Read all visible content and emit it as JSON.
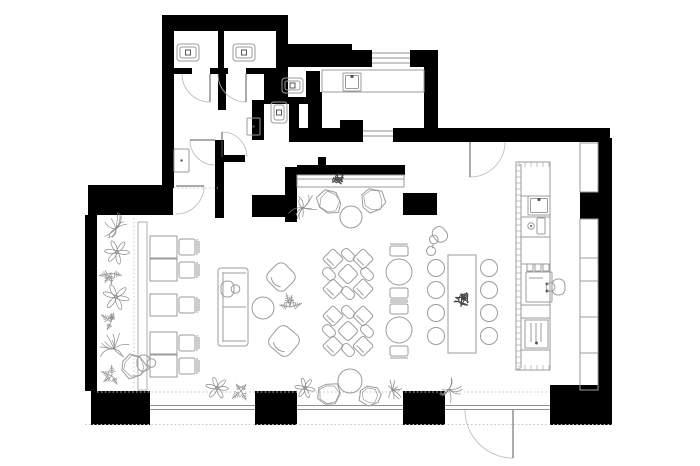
{
  "plan": {
    "name": "cafe-floor-plan",
    "canvas": {
      "width": 700,
      "height": 466,
      "background": "#ffffff"
    },
    "colors": {
      "wall": "#000000",
      "furniture": "#9b9b9b",
      "accent": "#555555",
      "plant": "#8a8a8a",
      "scribble": "#474747",
      "dotted": "#c4c4c4",
      "window": "#8f8f8f"
    },
    "walls": [
      [
        162,
        15,
        126,
        16
      ],
      [
        162,
        15,
        12,
        173
      ],
      [
        218,
        31,
        6,
        40
      ],
      [
        276,
        31,
        12,
        40
      ],
      [
        285,
        44,
        67,
        23
      ],
      [
        352,
        50,
        20,
        17
      ],
      [
        410,
        50,
        28,
        17
      ],
      [
        424,
        60,
        14,
        82
      ],
      [
        430,
        128,
        180,
        14
      ],
      [
        598,
        138,
        14,
        250
      ],
      [
        580,
        192,
        18,
        27
      ],
      [
        550,
        385,
        62,
        40
      ],
      [
        403,
        391,
        42,
        34
      ],
      [
        255,
        391,
        42,
        34
      ],
      [
        91,
        391,
        59,
        34
      ],
      [
        85,
        215,
        12,
        176
      ],
      [
        88,
        185,
        85,
        30
      ],
      [
        174,
        68,
        18,
        6
      ],
      [
        210,
        68,
        18,
        6
      ],
      [
        246,
        68,
        30,
        6
      ],
      [
        218,
        74,
        8,
        36
      ],
      [
        215,
        140,
        9,
        78
      ],
      [
        264,
        71,
        24,
        28
      ],
      [
        306,
        71,
        14,
        29
      ],
      [
        264,
        97,
        50,
        7
      ],
      [
        252,
        100,
        12,
        40
      ],
      [
        289,
        100,
        10,
        42
      ],
      [
        217,
        155,
        28,
        7
      ],
      [
        252,
        195,
        45,
        22
      ],
      [
        285,
        167,
        12,
        55
      ],
      [
        297,
        165,
        108,
        10
      ],
      [
        318,
        157,
        8,
        8
      ],
      [
        403,
        193,
        34,
        22
      ],
      [
        308,
        92,
        14,
        48
      ],
      [
        310,
        128,
        53,
        14
      ],
      [
        393,
        128,
        45,
        14
      ],
      [
        289,
        128,
        21,
        14
      ],
      [
        340,
        120,
        23,
        10
      ]
    ],
    "windows": [
      {
        "name": "window-kitchen-top",
        "x1": 372,
        "x2": 410,
        "ys": [
          53,
          58,
          63
        ]
      },
      {
        "name": "pass-through-window",
        "x1": 363,
        "x2": 393,
        "ys": [
          131,
          136
        ]
      },
      {
        "name": "window-bottom-left",
        "x1": 150,
        "x2": 255,
        "ys": [
          405.5,
          409.5
        ]
      },
      {
        "name": "window-bottom-center",
        "x1": 297,
        "x2": 403,
        "ys": [
          405.5,
          409.5
        ]
      },
      {
        "name": "entry-frame",
        "x1": 445,
        "x2": 550,
        "ys": [
          405.5,
          409.5
        ]
      }
    ],
    "doors": [
      {
        "name": "door-wc-stall-1",
        "cx": 210,
        "cy": 74,
        "r": 28,
        "a1": 90,
        "a2": 180,
        "leaf": "a1"
      },
      {
        "name": "door-wc-stall-2",
        "cx": 246,
        "cy": 74,
        "r": 28,
        "a1": 90,
        "a2": 180,
        "leaf": "a1"
      },
      {
        "name": "door-vestibule",
        "cx": 222,
        "cy": 157,
        "r": 25,
        "a1": 270,
        "a2": 360,
        "leaf": "a1"
      },
      {
        "name": "door-back-room",
        "cx": 215,
        "cy": 140,
        "r": 25,
        "a1": 90,
        "a2": 180,
        "leaf": "a2"
      },
      {
        "name": "door-hall-to-cafe",
        "cx": 176,
        "cy": 186,
        "r": 28,
        "a1": 0,
        "a2": 90,
        "leaf": "a1"
      },
      {
        "name": "door-service",
        "cx": 470,
        "cy": 142,
        "r": 35,
        "a1": 0,
        "a2": 90,
        "leaf": "a2"
      },
      {
        "name": "door-main-entrance",
        "cx": 513,
        "cy": 410,
        "r": 48,
        "a1": 90,
        "a2": 180,
        "leaf": "a1"
      }
    ],
    "dotted_lines": [
      [
        97,
        392,
        550,
        392
      ],
      [
        85,
        424.5,
        612,
        424.5
      ],
      [
        134,
        218,
        134,
        391
      ],
      [
        174,
        188,
        218,
        188
      ]
    ],
    "furniture": [
      {
        "type": "toilet",
        "name": "toilet",
        "x": 177,
        "y": 44,
        "w": 22,
        "h": 17
      },
      {
        "type": "toilet",
        "name": "toilet",
        "x": 233,
        "y": 44,
        "w": 22,
        "h": 17
      },
      {
        "type": "toilet",
        "name": "toilet",
        "x": 282,
        "y": 78,
        "w": 21,
        "h": 15
      },
      {
        "type": "toilet",
        "name": "toilet",
        "x": 271,
        "y": 102,
        "w": 16,
        "h": 21
      },
      {
        "type": "sink",
        "name": "washbasin",
        "x": 343,
        "y": 73,
        "w": 18,
        "h": 18
      },
      {
        "type": "sink",
        "name": "bar-sink",
        "x": 528,
        "y": 196,
        "w": 22,
        "h": 19
      },
      {
        "type": "panel",
        "name": "wall-fixture",
        "x": 174,
        "y": 149,
        "w": 15,
        "h": 23
      },
      {
        "type": "panel",
        "name": "wall-fixture",
        "x": 247,
        "y": 118,
        "w": 13,
        "h": 17
      },
      {
        "type": "counter",
        "name": "kitchen-counter",
        "x": 322,
        "y": 70,
        "w": 102,
        "h": 22
      },
      {
        "type": "bar",
        "name": "bar-counter",
        "x": 516,
        "y": 162,
        "w": 34,
        "h": 208
      },
      {
        "type": "tap",
        "name": "bar-tap",
        "x": 527,
        "y": 218
      },
      {
        "type": "coffee_machine",
        "name": "coffee-machine",
        "x": 526,
        "y": 264,
        "w": 26,
        "h": 38
      },
      {
        "type": "appliance",
        "name": "under-counter-appliance",
        "x": 525,
        "y": 320,
        "w": 23,
        "h": 28
      },
      {
        "type": "shelf",
        "name": "wall-shelf",
        "x": 580,
        "y": 143,
        "w": 18,
        "h": 49
      },
      {
        "type": "shelf",
        "name": "wall-shelf",
        "x": 580,
        "y": 219,
        "w": 18,
        "h": 39
      },
      {
        "type": "shelf",
        "name": "wall-shelf",
        "x": 580,
        "y": 258,
        "w": 18,
        "h": 23
      },
      {
        "type": "shelf",
        "name": "wall-shelf",
        "x": 580,
        "y": 281,
        "w": 18,
        "h": 36
      },
      {
        "type": "shelf",
        "name": "wall-shelf",
        "x": 580,
        "y": 317,
        "w": 18,
        "h": 36
      },
      {
        "type": "shelf",
        "name": "wall-shelf",
        "x": 580,
        "y": 353,
        "w": 18,
        "h": 37
      },
      {
        "type": "bench",
        "name": "banquette-bench",
        "x": 297,
        "y": 175,
        "w": 107,
        "h": 12
      },
      {
        "type": "bench_line",
        "name": "wall-bench",
        "x": 138,
        "y": 222,
        "w": 9,
        "h": 168
      },
      {
        "type": "table_chair",
        "name": "table-for-one",
        "x": 150,
        "y": 236
      },
      {
        "type": "table_chair",
        "name": "table-for-one",
        "x": 150,
        "y": 259
      },
      {
        "type": "table_chair",
        "name": "table-for-one",
        "x": 150,
        "y": 294
      },
      {
        "type": "table_chair",
        "name": "table-for-one",
        "x": 150,
        "y": 332
      },
      {
        "type": "table_chair",
        "name": "table-for-one",
        "x": 150,
        "y": 355
      },
      {
        "type": "sofa",
        "name": "lounge-sofa",
        "x": 218,
        "y": 268,
        "w": 30,
        "h": 78
      },
      {
        "type": "person",
        "name": "seated-guest",
        "x": 230,
        "y": 289,
        "rot": 0
      },
      {
        "type": "round_table",
        "name": "coffee-table",
        "cx": 263,
        "cy": 308,
        "r": 11
      },
      {
        "type": "armchair",
        "name": "armchair",
        "cx": 281,
        "cy": 277,
        "s": 24,
        "rot": 45
      },
      {
        "type": "armchair",
        "name": "armchair",
        "cx": 284,
        "cy": 341,
        "s": 26,
        "rot": 40
      },
      {
        "type": "blob_chair",
        "name": "lounge-chair",
        "cx": 329,
        "cy": 202,
        "r": 13,
        "seed": 3
      },
      {
        "type": "blob_chair",
        "name": "lounge-chair",
        "cx": 373,
        "cy": 201,
        "r": 13,
        "seed": 7
      },
      {
        "type": "round_table",
        "name": "round-table",
        "cx": 351,
        "cy": 217,
        "r": 11
      },
      {
        "type": "cluster4",
        "name": "four-seat-table",
        "cx": 348,
        "cy": 274
      },
      {
        "type": "cluster4",
        "name": "four-seat-table",
        "cx": 348,
        "cy": 331
      },
      {
        "type": "table_2chairs",
        "name": "two-seat-table",
        "cx": 399,
        "cy": 272,
        "r": 13
      },
      {
        "type": "table_2chairs",
        "name": "two-seat-table",
        "cx": 399,
        "cy": 330,
        "r": 13
      },
      {
        "type": "comm_table",
        "name": "communal-table",
        "x": 448,
        "y": 255,
        "w": 28,
        "h": 98
      },
      {
        "type": "stool",
        "name": "stool",
        "cx": 436,
        "cy": 268,
        "r": 8.5
      },
      {
        "type": "stool",
        "name": "stool",
        "cx": 436,
        "cy": 290,
        "r": 8.5
      },
      {
        "type": "stool",
        "name": "stool",
        "cx": 436,
        "cy": 313,
        "r": 8.5
      },
      {
        "type": "stool",
        "name": "stool",
        "cx": 436,
        "cy": 336,
        "r": 8.5
      },
      {
        "type": "stool",
        "name": "stool",
        "cx": 489,
        "cy": 268,
        "r": 8.5
      },
      {
        "type": "stool",
        "name": "stool",
        "cx": 489,
        "cy": 290,
        "r": 8.5
      },
      {
        "type": "stool",
        "name": "stool",
        "cx": 489,
        "cy": 313,
        "r": 8.5
      },
      {
        "type": "stool",
        "name": "stool",
        "cx": 489,
        "cy": 336,
        "r": 8.5
      },
      {
        "type": "person",
        "name": "waiter",
        "x": 438,
        "y": 236,
        "rot": 140,
        "tray": true
      },
      {
        "type": "person",
        "name": "barista",
        "x": 556,
        "y": 287,
        "rot": 180
      },
      {
        "type": "person",
        "name": "seated-guest",
        "x": 146,
        "y": 363,
        "rot": 0
      },
      {
        "type": "blob_chair",
        "name": "lounge-chair",
        "cx": 134,
        "cy": 366,
        "r": 13,
        "seed": 11
      },
      {
        "type": "blob_chair",
        "name": "window-chair",
        "cx": 329,
        "cy": 394,
        "r": 12,
        "seed": 5
      },
      {
        "type": "round_table",
        "name": "round-table",
        "cx": 350,
        "cy": 381,
        "r": 12
      },
      {
        "type": "blob_chair",
        "name": "window-chair",
        "cx": 370,
        "cy": 395,
        "r": 11,
        "seed": 9
      },
      {
        "type": "plant",
        "kind": "palm",
        "name": "plant",
        "cx": 116,
        "cy": 229,
        "r": 17,
        "seed": 1
      },
      {
        "type": "plant",
        "kind": "flower",
        "name": "plant",
        "cx": 117,
        "cy": 252,
        "r": 12,
        "seed": 2
      },
      {
        "type": "plant",
        "kind": "fern",
        "name": "plant",
        "cx": 111,
        "cy": 273,
        "r": 12,
        "seed": 3
      },
      {
        "type": "plant",
        "kind": "flower",
        "name": "plant",
        "cx": 116,
        "cy": 297,
        "r": 13,
        "seed": 4
      },
      {
        "type": "plant",
        "kind": "fern",
        "name": "plant",
        "cx": 111,
        "cy": 322,
        "r": 12,
        "seed": 5
      },
      {
        "type": "plant",
        "kind": "palm",
        "name": "plant",
        "cx": 114,
        "cy": 349,
        "r": 16,
        "seed": 6
      },
      {
        "type": "plant",
        "kind": "fern",
        "name": "plant",
        "cx": 112,
        "cy": 376,
        "r": 11,
        "seed": 7
      },
      {
        "type": "plant",
        "kind": "palm",
        "name": "plant",
        "cx": 303,
        "cy": 208,
        "r": 15,
        "seed": 8
      },
      {
        "type": "plant",
        "kind": "scribble",
        "name": "plant-on-bench",
        "cx": 337,
        "cy": 179,
        "r": 8,
        "seed": 9
      },
      {
        "type": "plant",
        "kind": "fern",
        "name": "plant",
        "cx": 290,
        "cy": 307,
        "r": 13,
        "seed": 10
      },
      {
        "type": "plant",
        "kind": "scribble",
        "name": "plant-on-table",
        "cx": 462,
        "cy": 300,
        "r": 9,
        "seed": 11
      },
      {
        "type": "plant",
        "kind": "flower",
        "name": "plant",
        "cx": 217,
        "cy": 388,
        "r": 11,
        "seed": 12
      },
      {
        "type": "plant",
        "kind": "fern",
        "name": "plant",
        "cx": 241,
        "cy": 391,
        "r": 12,
        "seed": 13
      },
      {
        "type": "plant",
        "kind": "flower",
        "name": "plant",
        "cx": 305,
        "cy": 388,
        "r": 10,
        "seed": 14
      },
      {
        "type": "plant",
        "kind": "palm",
        "name": "plant",
        "cx": 392,
        "cy": 390,
        "r": 11,
        "seed": 15
      },
      {
        "type": "plant",
        "kind": "palm",
        "name": "plant",
        "cx": 449,
        "cy": 389,
        "r": 13,
        "seed": 16
      }
    ]
  }
}
